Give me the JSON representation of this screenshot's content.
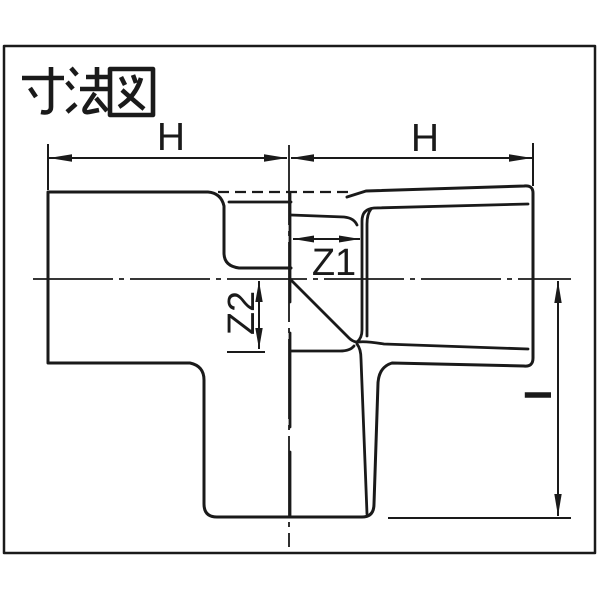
{
  "title": "寸法図",
  "dimension_labels": {
    "left_h": "H",
    "right_h": "H",
    "z1": "Z1",
    "z2": "Z2",
    "right_i": "I"
  },
  "colors": {
    "line": "#1a1a1a",
    "background": "#ffffff"
  }
}
